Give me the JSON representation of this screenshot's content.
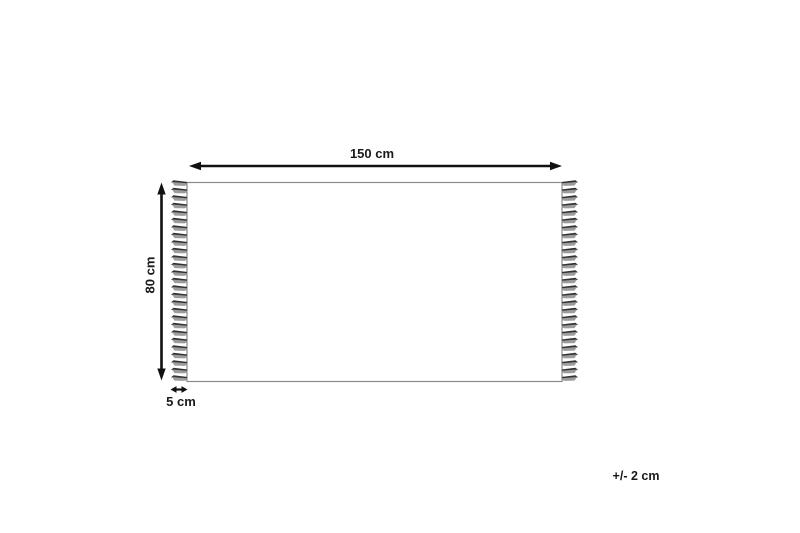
{
  "diagram": {
    "type": "rug-dimension-diagram",
    "labels": {
      "width": "150 cm",
      "height": "80 cm",
      "fringe": "5 cm",
      "tolerance": "+/- 2 cm"
    },
    "dimensions": {
      "width_cm": 150,
      "height_cm": 80,
      "fringe_cm": 5,
      "tolerance_cm": 2,
      "unit": "cm"
    },
    "fringe": {
      "sides": [
        "left",
        "right"
      ],
      "tassels_per_side": 27
    },
    "colors": {
      "background": "#ffffff",
      "arrow": "#111111",
      "outline": "#8a8a8a",
      "tassel_dark": "#333333",
      "tassel_light": "#9c9c9c",
      "text": "#1a1a1a"
    }
  }
}
